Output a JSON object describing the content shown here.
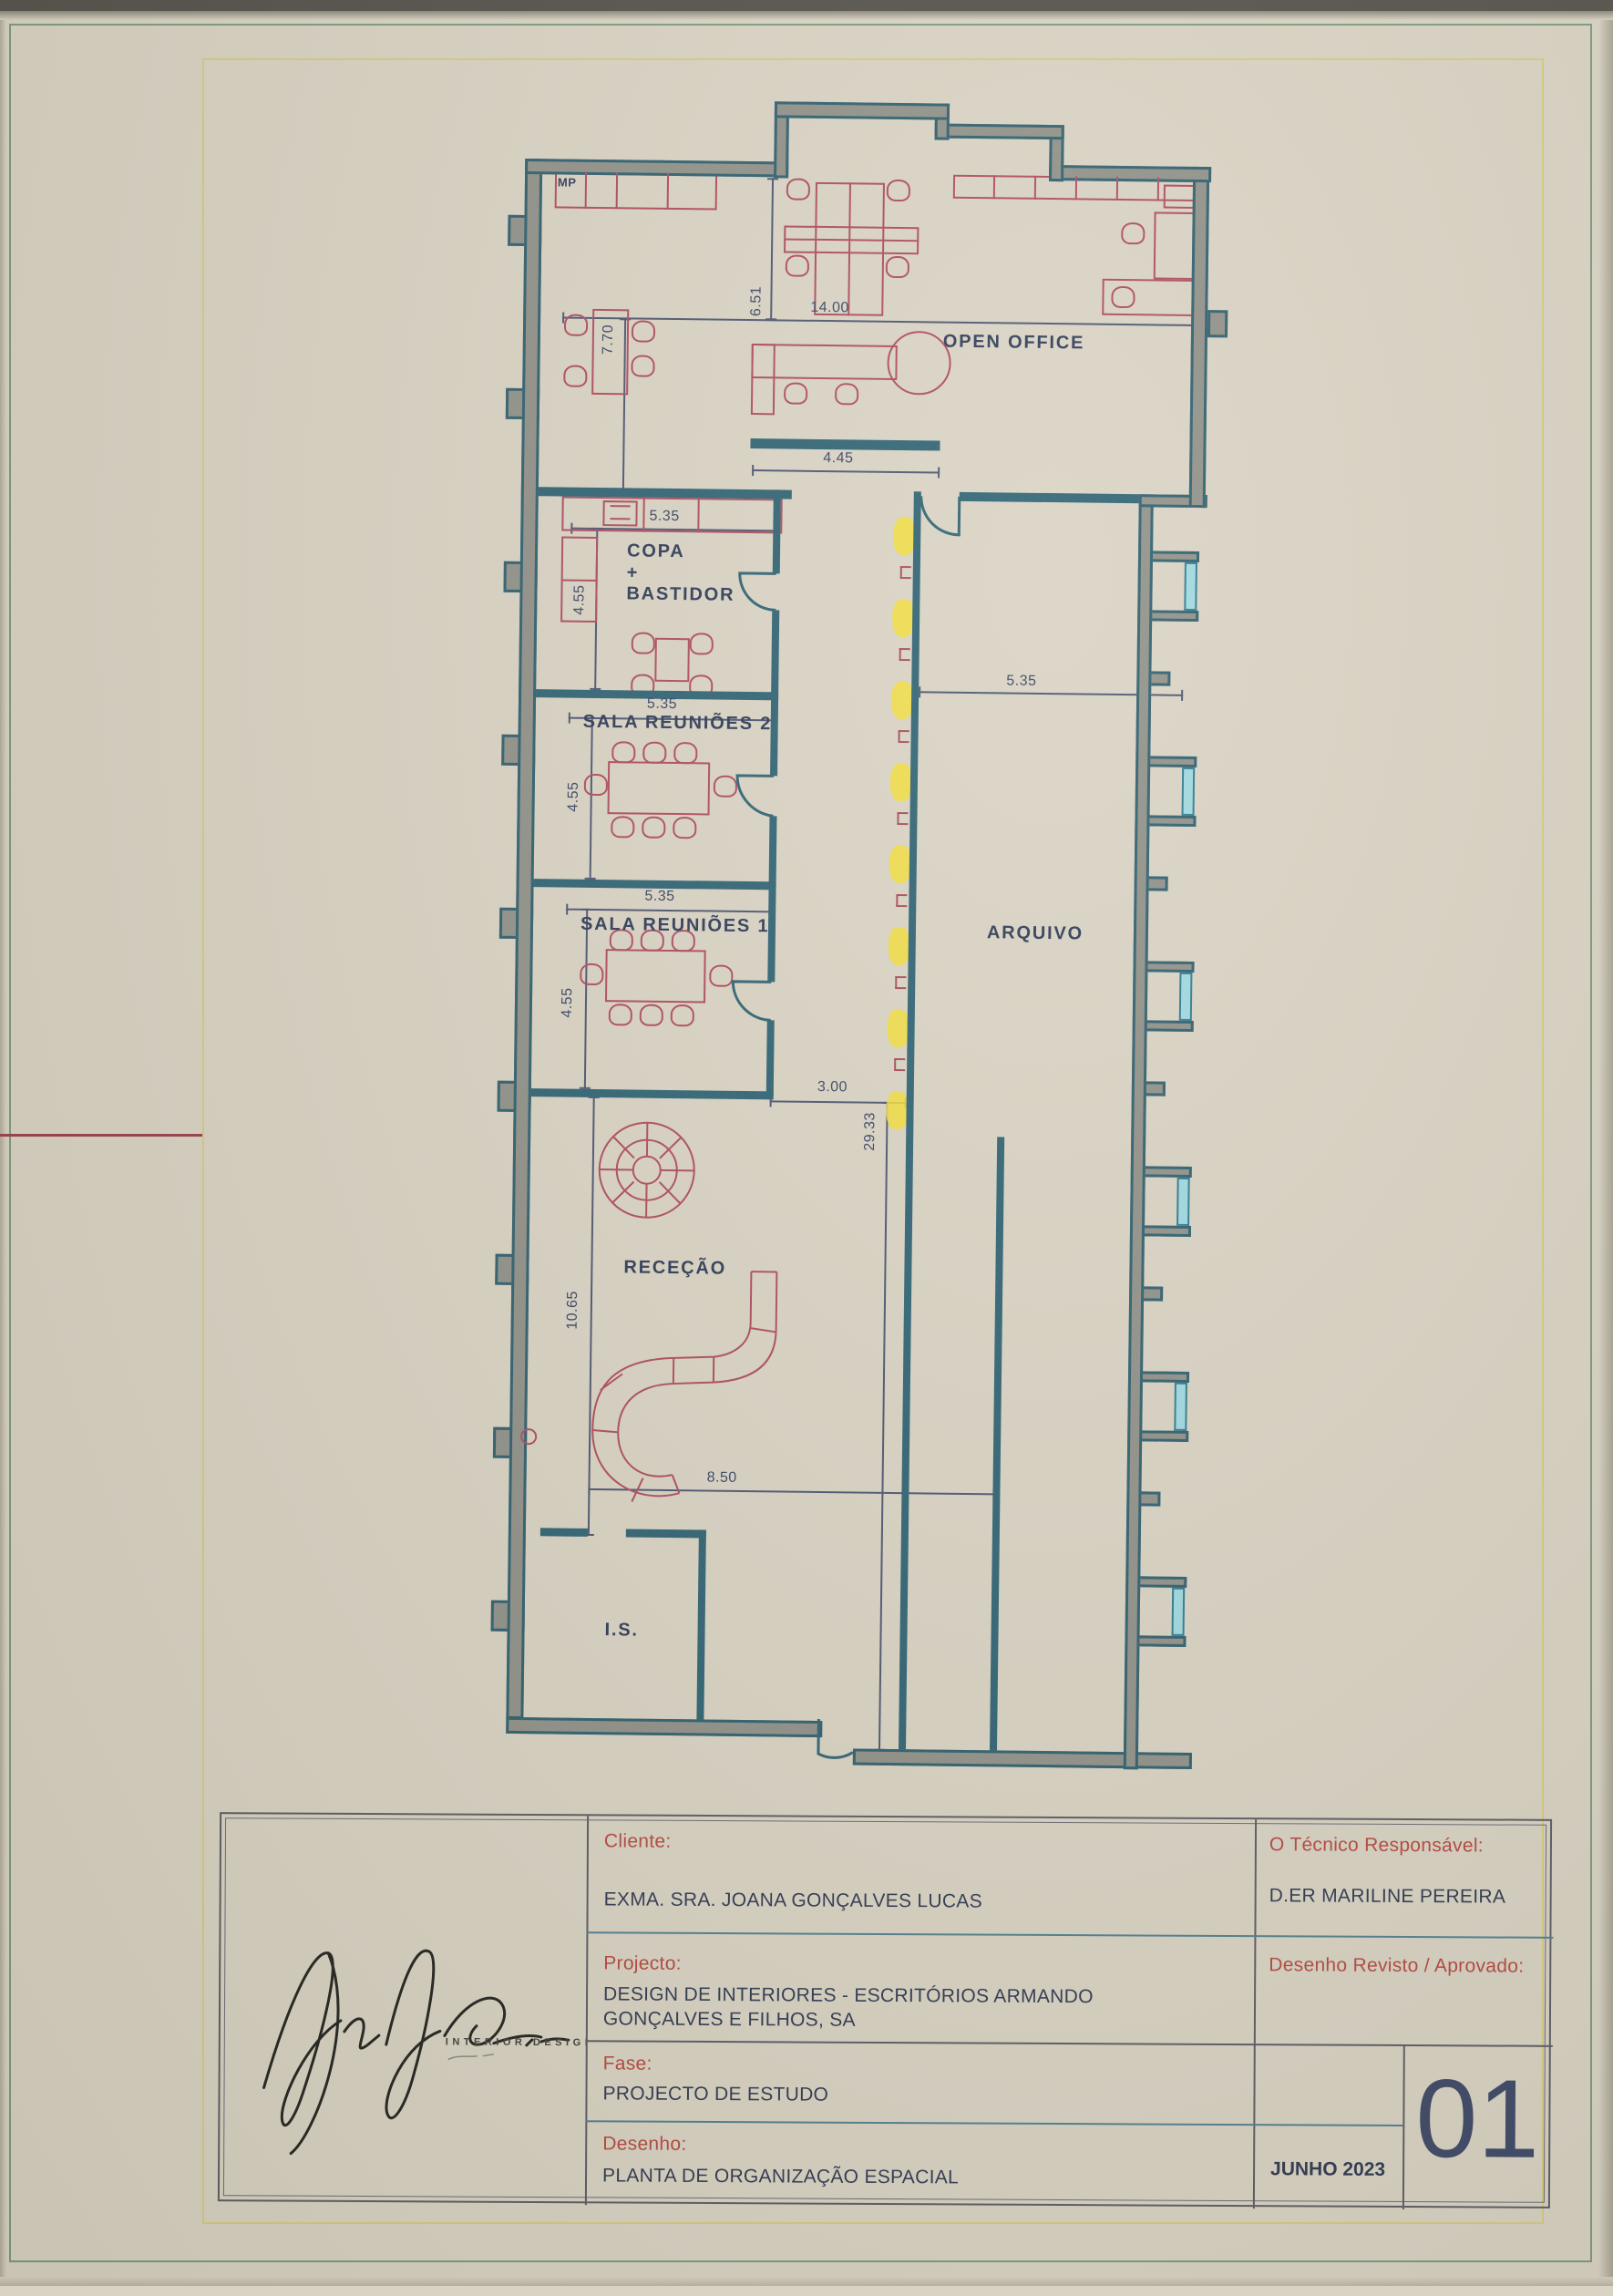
{
  "plan": {
    "rooms": {
      "open_office": "OPEN OFFICE",
      "copa_1": "COPA",
      "copa_2": "+",
      "copa_3": "BASTIDOR",
      "sala_reunioes_2": "SALA REUNIÕES 2",
      "sala_reunioes_1": "SALA REUNIÕES 1",
      "arquivo": "ARQUIVO",
      "rececao": "RECEÇÃO",
      "is": "I.S.",
      "mp": "MP"
    },
    "dimensions": {
      "top_width": "14.00",
      "open_office_depth": "6.51",
      "mp_depth": "7.70",
      "screen_wall": "4.45",
      "copa_width": "5.35",
      "copa_depth": "4.55",
      "sr2_width": "5.35",
      "sr2_depth": "4.55",
      "sr1_width": "5.35",
      "sr1_depth": "4.55",
      "arquivo_width": "5.35",
      "corridor_width": "3.00",
      "corridor_length": "29.33",
      "rececao_depth": "10.65",
      "rececao_width": "8.50"
    }
  },
  "title_block": {
    "cliente_label": "Cliente:",
    "cliente_value": "EXMA. SRA. JOANA GONÇALVES LUCAS",
    "projecto_label": "Projecto:",
    "projecto_value_1": "DESIGN DE INTERIORES - ESCRITÓRIOS ARMANDO",
    "projecto_value_2": "GONÇALVES E FILHOS, SA",
    "fase_label": "Fase:",
    "fase_value": "PROJECTO DE ESTUDO",
    "desenho_label": "Desenho:",
    "desenho_value": "PLANTA DE ORGANIZAÇÃO ESPACIAL",
    "tecnico_label": "O Técnico Responsável:",
    "tecnico_value": "D.ER MARILINE PEREIRA",
    "revisto_label": "Desenho Revisto / Aprovado:",
    "date": "JUNHO 2023",
    "sheet_number": "01",
    "logo_caption": "INTERIOR DESIGN"
  },
  "colors": {
    "paper": "#d9d3c3",
    "wall_teal": "#2e6272",
    "wall_gray": "#8f9087",
    "window_teal": "#9fd8e0",
    "furniture_red": "#ae4a5e",
    "highlight_yellow": "#f2dd3a",
    "frame_yellow": "#d6cc7e",
    "frame_green": "#7d9a7b",
    "dim_navy": "#3a4464",
    "label_red": "#b5473f"
  }
}
